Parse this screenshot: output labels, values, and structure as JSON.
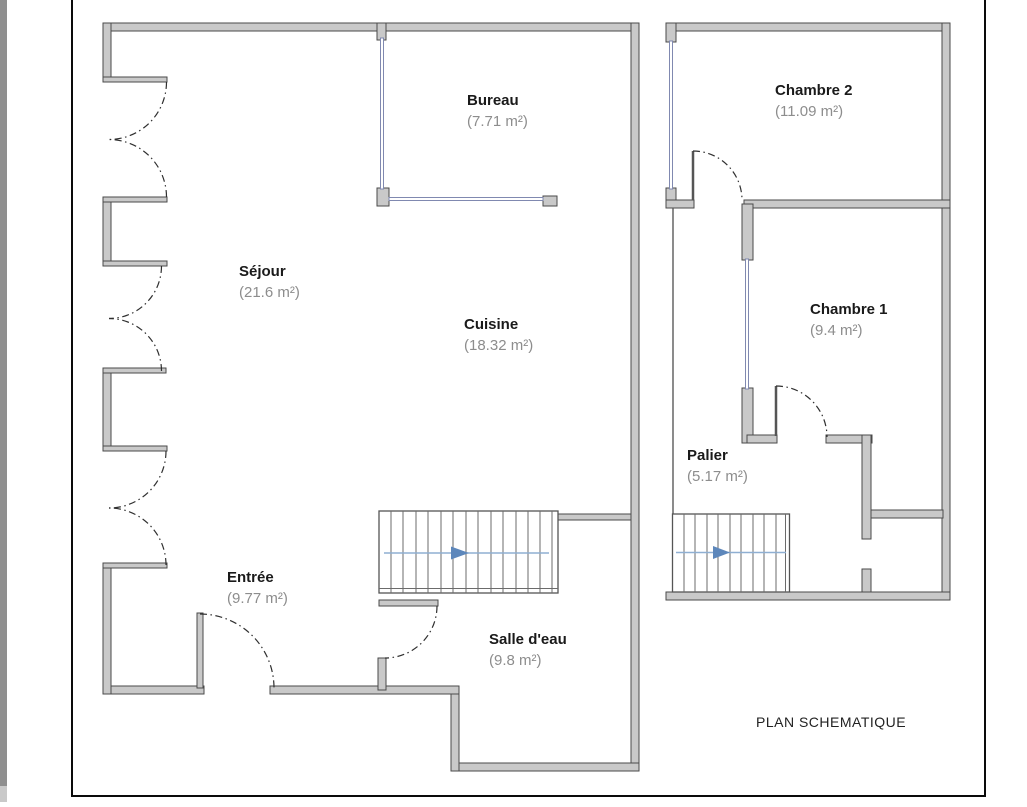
{
  "title": "PLAN SCHEMATIQUE",
  "floors": {
    "ground": {
      "rooms": [
        {
          "name": "Bureau",
          "area": "(7.71 m²)"
        },
        {
          "name": "Séjour",
          "area": "(21.6 m²)"
        },
        {
          "name": "Cuisine",
          "area": "(18.32 m²)"
        },
        {
          "name": "Entrée",
          "area": "(9.77 m²)"
        },
        {
          "name": "Salle d'eau",
          "area": "(9.8 m²)"
        }
      ],
      "stairs_direction": "right"
    },
    "upper": {
      "rooms": [
        {
          "name": "Chambre 2",
          "area": "(11.09 m²)"
        },
        {
          "name": "Chambre 1",
          "area": "(9.4 m²)"
        },
        {
          "name": "Palier",
          "area": "(5.17 m²)"
        }
      ],
      "stairs_direction": "right"
    }
  },
  "colors": {
    "wall_fill": "#c9c9c9",
    "wall_outline": "#4a4a4a",
    "window_line": "#8089b0",
    "door_arc": "#2f2f2f",
    "stair_line": "#8fafd2",
    "stair_arrow": "#5d87bb",
    "room_name_text": "#1a1a1a",
    "room_area_text": "#8d8d8d",
    "page_border": "#0a0a0a"
  }
}
